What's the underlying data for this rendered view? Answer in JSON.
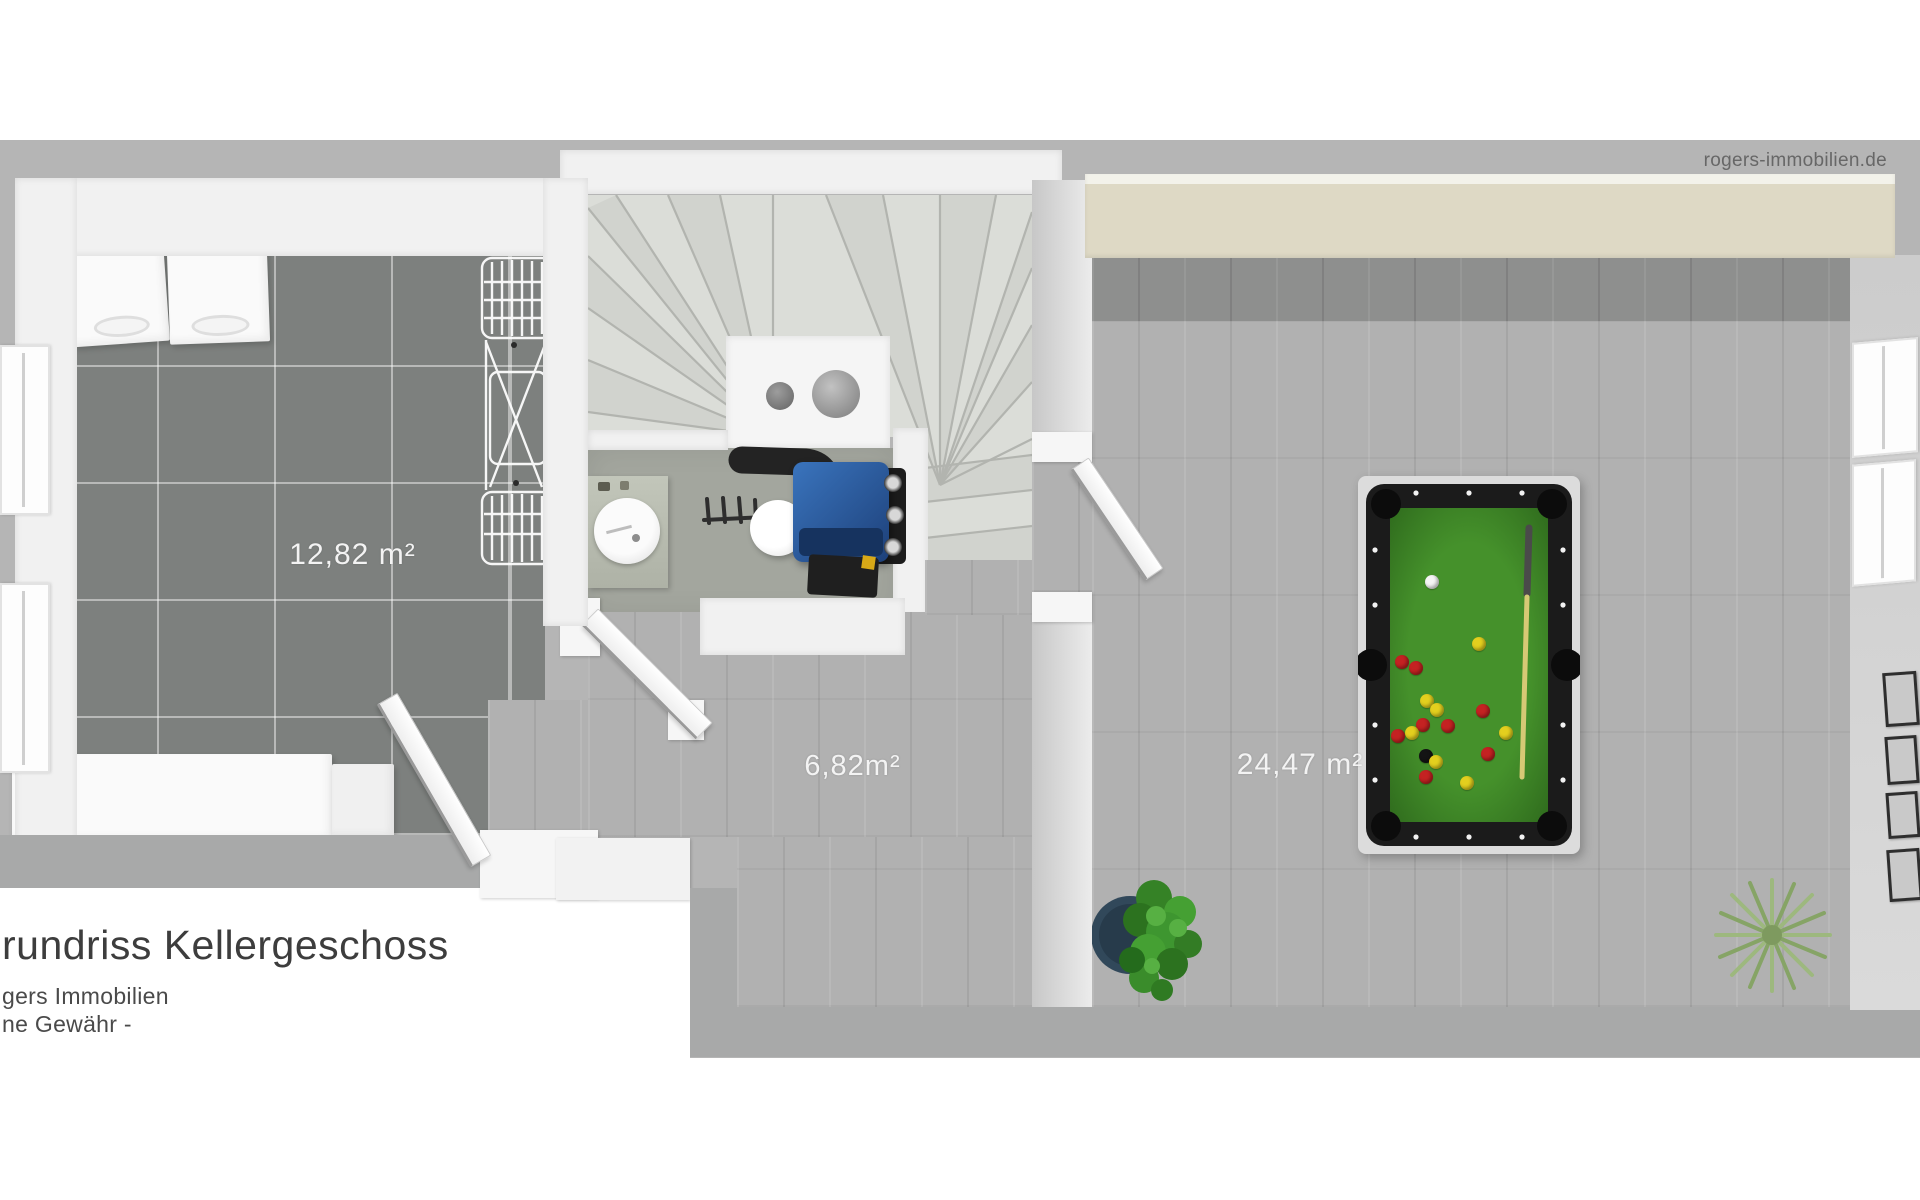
{
  "watermark": {
    "text": "rogers-immobilien.de"
  },
  "footer": {
    "title": "rundriss Kellergeschoss",
    "line1": "gers Immobilien",
    "line2": "ne Gewähr -"
  },
  "rooms": {
    "laundry": {
      "area": "12,82 m²"
    },
    "hall": {
      "area": "6,82m²"
    },
    "hobby": {
      "area": "24,47 m²"
    }
  },
  "colors": {
    "backdrop": "#b5b5b5",
    "tile_floor": "#7d807e",
    "wood_floor": "#b1b1b1",
    "concrete_floor": "#a3a69e",
    "wall_white": "#f1f1f1",
    "wall_cream": "#ded9c5",
    "pool_felt": "#3f8a28",
    "pool_rail": "#1b1b1b",
    "boiler_blue": "#2a5ea6",
    "plant_leafy": "#3e9630",
    "plant_spiky": "#9cb97f"
  },
  "pool_table": {
    "ball_colors": {
      "white": "#f5f5f5",
      "yellow": "#e3cf1e",
      "red": "#c42222",
      "black": "#141414"
    },
    "balls": [
      {
        "color": "white",
        "x": 1432,
        "y": 582
      },
      {
        "color": "yellow",
        "x": 1479,
        "y": 644
      },
      {
        "color": "red",
        "x": 1402,
        "y": 662
      },
      {
        "color": "red",
        "x": 1416,
        "y": 668
      },
      {
        "color": "yellow",
        "x": 1427,
        "y": 701
      },
      {
        "color": "yellow",
        "x": 1437,
        "y": 710
      },
      {
        "color": "red",
        "x": 1483,
        "y": 711
      },
      {
        "color": "red",
        "x": 1423,
        "y": 725
      },
      {
        "color": "red",
        "x": 1448,
        "y": 726
      },
      {
        "color": "yellow",
        "x": 1412,
        "y": 733
      },
      {
        "color": "red",
        "x": 1398,
        "y": 736
      },
      {
        "color": "yellow",
        "x": 1506,
        "y": 733
      },
      {
        "color": "black",
        "x": 1426,
        "y": 756
      },
      {
        "color": "yellow",
        "x": 1436,
        "y": 762
      },
      {
        "color": "red",
        "x": 1488,
        "y": 754
      },
      {
        "color": "red",
        "x": 1426,
        "y": 777
      },
      {
        "color": "yellow",
        "x": 1467,
        "y": 783
      }
    ]
  }
}
